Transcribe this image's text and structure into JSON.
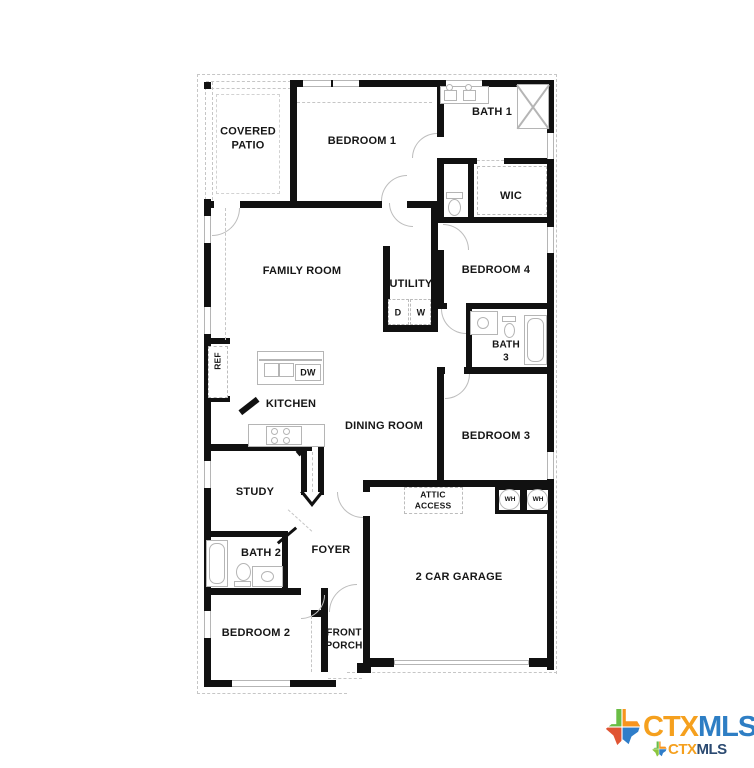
{
  "rooms": {
    "covered_patio": "COVERED\nPATIO",
    "bedroom1": "BEDROOM 1",
    "bath1": "BATH 1",
    "wic": "WIC",
    "family_room": "FAMILY ROOM",
    "utility": "UTILITY",
    "bedroom4": "BEDROOM 4",
    "bath3": "BATH\n3",
    "kitchen": "KITCHEN",
    "dining_room": "DINING ROOM",
    "bedroom3": "BEDROOM 3",
    "study": "STUDY",
    "attic_access": "ATTIC\nACCESS",
    "bath2": "BATH 2",
    "foyer": "FOYER",
    "garage": "2 CAR GARAGE",
    "bedroom2": "BEDROOM 2",
    "front_porch": "FRONT\nPORCH"
  },
  "fixtures": {
    "ref": "REF",
    "dw": "DW",
    "dryer": "D",
    "washer": "W",
    "wh1": "WH",
    "wh2": "WH"
  },
  "logo": {
    "ctx": "CTX",
    "mls": "MLS",
    "ctx_small": "CTX",
    "mls_small": "MLS"
  },
  "colors": {
    "wall": "#111111",
    "fixture_gray": "#b5b5b5",
    "ctx_orange": "#F5A01E",
    "mls_blue": "#2E7EC4",
    "mls_navy": "#2B4A71",
    "texas_green": "#6ABD45",
    "texas_orange": "#F7941E",
    "texas_red": "#E05433",
    "texas_blue": "#2F7DC9"
  }
}
